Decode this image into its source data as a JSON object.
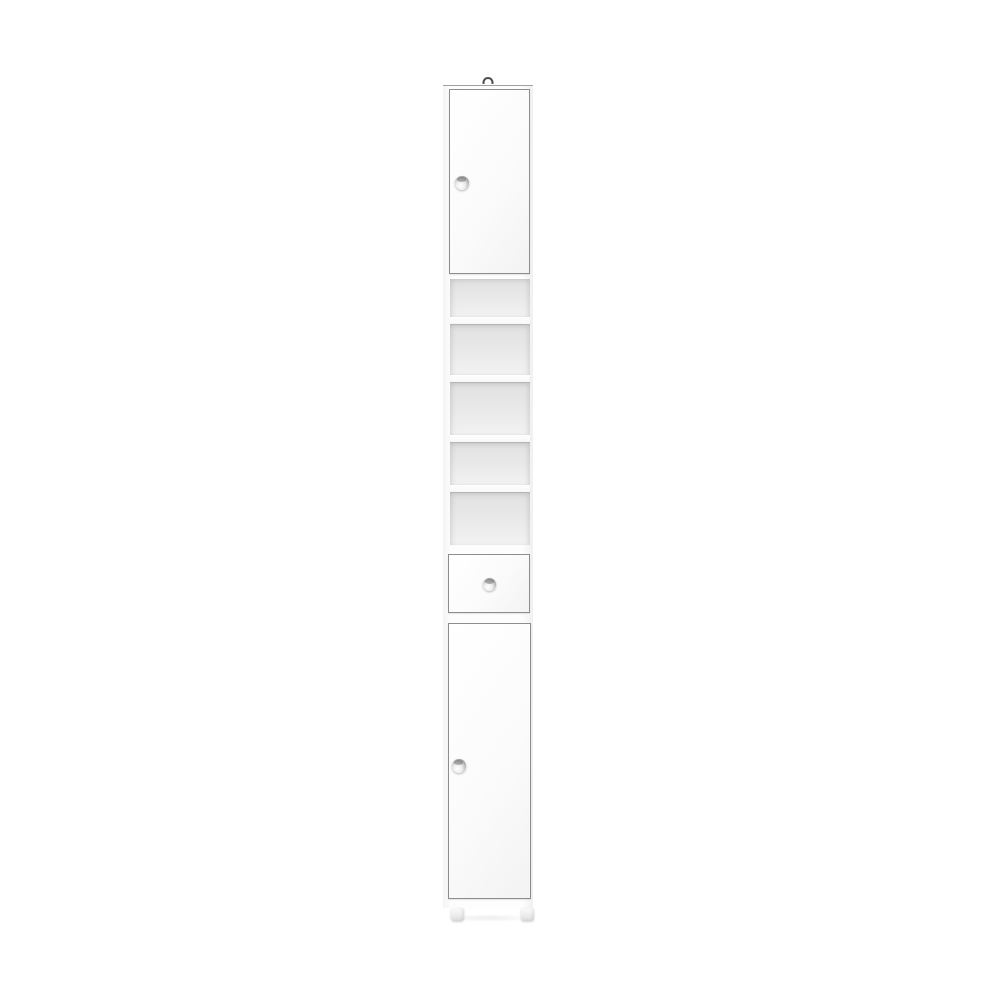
{
  "scene": {
    "type": "product-photo",
    "description": "Tall narrow freestanding white bathroom tallboy storage cabinet photographed on a plain white background",
    "background_color": "#ffffff"
  },
  "cabinet": {
    "colors": {
      "background": "#ffffff",
      "body": "#fdfdfd",
      "panel_edge": "#8d8d8d",
      "interior_shade": "#e7e7e7",
      "shelf_face": "#ffffff",
      "knob_metal": "#b9b9b9",
      "hook": "#4f4f4f",
      "foot": "#ededed"
    },
    "parts": {
      "hook": {
        "name": "top-hanging-hook",
        "count": 1
      },
      "upper_door": {
        "name": "upper-cabinet-door",
        "knob": "round-chrome-knob",
        "knob_side": "left"
      },
      "open_shelves": {
        "name": "open-shelf-section",
        "compartment_count": 5,
        "compartment_heights_px": [
          38,
          50,
          52,
          42,
          52
        ],
        "shelf_thickness_px": 8
      },
      "drawer": {
        "name": "storage-drawer",
        "knob": "round-chrome-knob",
        "knob_side": "center"
      },
      "lower_door": {
        "name": "lower-cabinet-door",
        "knob": "round-chrome-knob",
        "knob_side": "left"
      },
      "feet": {
        "name": "plinth-feet",
        "count": 2
      }
    }
  }
}
